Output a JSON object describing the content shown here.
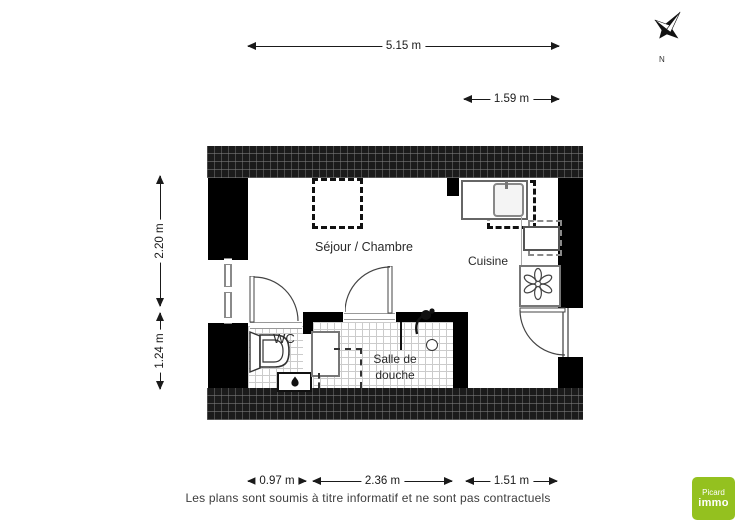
{
  "dimensions": {
    "top": "5.15 m",
    "top_right": "1.59 m",
    "left_upper": "2.20 m",
    "left_lower": "1.24 m",
    "bottom_left": "0.97 m",
    "bottom_center": "2.36 m",
    "bottom_right": "1.51 m"
  },
  "rooms": {
    "living": "Séjour / Chambre",
    "kitchen": "Cuisine",
    "wc": "WC",
    "shower": "Salle de douche"
  },
  "compass": {
    "north": "N"
  },
  "footer": {
    "disclaimer": "Les plans sont soumis à titre informatif et ne sont pas contractuels"
  },
  "logo": {
    "line1": "Picard",
    "line2": "immo",
    "bg_style": "background:#94c11f"
  },
  "colors": {
    "wall": "#000000",
    "tile_line": "#cbcbcb",
    "skylight_dash": "#111111",
    "logo_green": "#94c11f"
  },
  "icons": [
    "compass-north-icon",
    "window-symbol",
    "door-arc",
    "skylight-dashed",
    "sink-icon",
    "faucet-icon",
    "appliance-icon",
    "extractor-fan-icon",
    "toilet-icon",
    "water-heater-flame-icon",
    "shower-head-icon",
    "drain-icon"
  ]
}
